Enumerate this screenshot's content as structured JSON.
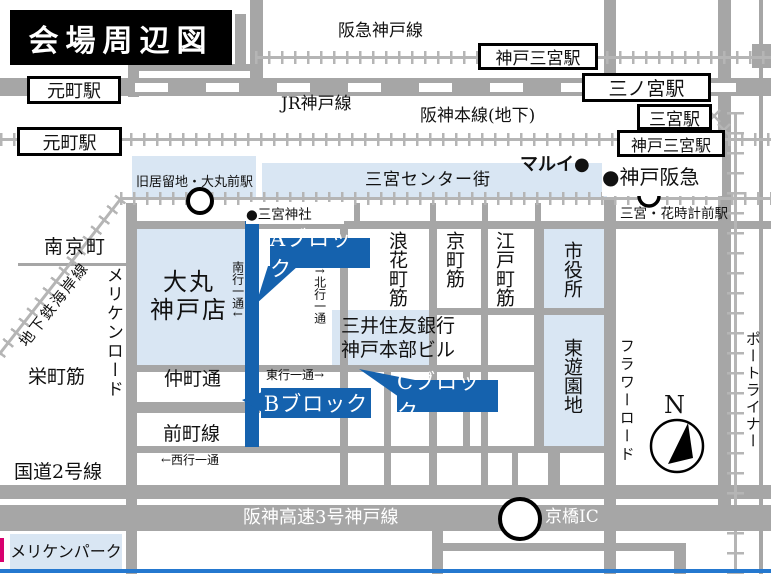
{
  "title": "会場周辺図",
  "colors": {
    "accent_blue": "#1562ae",
    "light_blue": "#d9e6f3",
    "road_gray": "#a6a6a6",
    "rail_gray": "#b5b5b5",
    "bottom_border_blue": "#2478cf"
  },
  "railways": {
    "hankyu": "阪急神戸線",
    "jr": "JR神戸線",
    "hanshin": "阪神本線(地下)",
    "subway_kaigan": "地下鉄海岸線",
    "portliner": "ポートライナー"
  },
  "stations": {
    "motomachi_jr": "元町駅",
    "motomachi_hanshin": "元町駅",
    "kobe_sannomiya_hankyu": "神戸三宮駅",
    "sannomiya_jr": "三ノ宮駅",
    "sannomiya_subway": "三宮駅",
    "kobe_sannomiya_hanshin": "神戸三宮駅",
    "kyukyoryuchi_daimarumae": "旧居留地・大丸前駅",
    "hanadokei_mae": "三宮・花時計前駅"
  },
  "landmarks": {
    "center_street": "三宮センター街",
    "marui": "マルイ●",
    "kobe_hankyu": "●神戸阪急",
    "sannomiya_shrine": "●三宮神社",
    "daimaru_line1": "大丸",
    "daimaru_line2": "神戸店",
    "smbc_line1": "三井住友銀行",
    "smbc_line2": "神戸本部ビル",
    "city_hall": "市役所",
    "higashi_yuenchi": "東遊園地",
    "meriken_park": "メリケンパーク",
    "nankinmachi": "南京町"
  },
  "blocks": {
    "a": "Aブロック",
    "b": "Bブロック",
    "c": "Cブロック"
  },
  "streets": {
    "naniwamachi": "浪花町筋",
    "kyomachi": "京町筋",
    "edomachi": "江戸町筋",
    "meriken_road": "メリケンロード",
    "flower_road": "フラワーロード",
    "sakaemachi": "栄町筋",
    "nakamachi": "仲町通",
    "maemachi": "前町線",
    "route2": "国道2号線",
    "hanshin_expressway": "阪神高速3号神戸線",
    "kyobashi_ic": "京橋IC"
  },
  "one_way": {
    "southbound": "南行一通↓",
    "northbound": "↑北行一通",
    "eastbound": "東行一通→",
    "westbound": "←西行一通"
  },
  "compass_n": "N"
}
